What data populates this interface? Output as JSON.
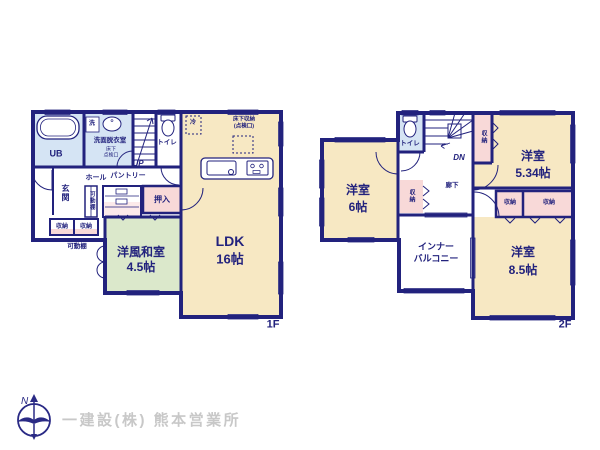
{
  "colors": {
    "wall_navy": "#22227d",
    "room_cream": "#f7e8c3",
    "room_green": "#dbe8cb",
    "room_blue": "#d5e4f4",
    "room_pink": "#f8d9d8",
    "window_blue": "#cfdef1",
    "logo_gray": "#c8c8c8"
  },
  "f1": {
    "floor_label": "1F",
    "ub": "UB",
    "washer": "洗",
    "washroom": "洗面脱衣室",
    "washroom_note_1": "床下",
    "washroom_note_2": "点検口",
    "toilet": "トイレ",
    "stairs": "UP",
    "hall": "ホール",
    "pantry": "パントリー",
    "entrance": "玄関",
    "movable_shelf_upper": "可動棚",
    "movable_shelf_lower": "可動棚",
    "closet": "押入",
    "storage_a": "収納",
    "storage_b": "収納",
    "washitsu_name": "洋風和室",
    "washitsu_size": "4.5帖",
    "ldk_name": "LDK",
    "ldk_size": "16帖",
    "fridge": "冷",
    "floor_storage_1": "床下収納",
    "floor_storage_2": "(点検口)"
  },
  "f2": {
    "floor_label": "2F",
    "toilet": "トイレ",
    "stairs": "DN",
    "corridor": "廊下",
    "storage_stair": "収納",
    "storage_west": "収納",
    "storage_a": "収納",
    "storage_b": "収納",
    "room_534_name": "洋室",
    "room_534_size": "5.34帖",
    "room_6_name": "洋室",
    "room_6_size": "6帖",
    "room_85_name": "洋室",
    "room_85_size": "8.5帖",
    "balcony_line_1": "インナー",
    "balcony_line_2": "バルコニー"
  },
  "footer": {
    "company": "一建設(株) 熊本営業所",
    "compass": "N"
  }
}
